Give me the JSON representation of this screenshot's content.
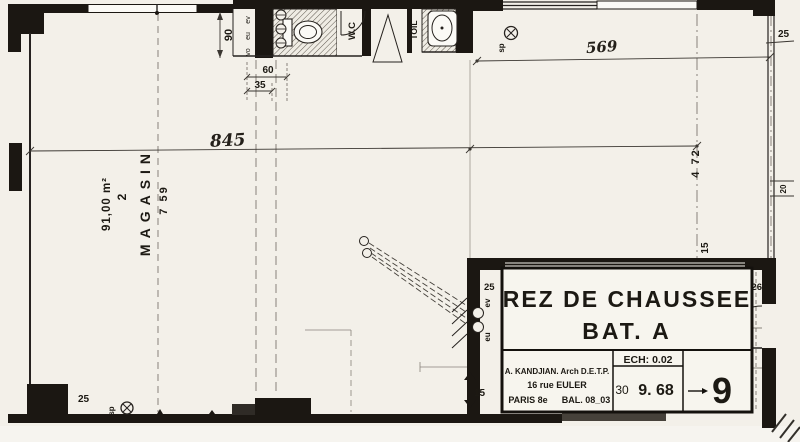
{
  "plan": {
    "rooms": {
      "magasin": {
        "label": "MAGASIN",
        "number": "2",
        "area": "91,00 m²"
      },
      "wc_label": "W.C",
      "toil_label": "TOIL"
    },
    "dimensions": {
      "width_845": "845",
      "width_569": "569",
      "height_759": "7 59",
      "height_472": "4 72",
      "wc_90": "90",
      "wc_60": "60",
      "wc_35": "35",
      "wall_25_top_right": "25",
      "wall_25_bottom_left": "25",
      "wall_25_office": "25",
      "wall_26": "26",
      "wall_15_office": "15",
      "wall_15_right": "15",
      "wall_20": "20"
    },
    "annotations": {
      "sp_top": "sp",
      "sp_bottom": "sp",
      "ev": "ev",
      "eu": "eu",
      "stack_1": "ev",
      "stack_2": "eu",
      "stack_3": "vo"
    }
  },
  "title_block": {
    "title_line1": "REZ DE CHAUSSEE",
    "title_line2": "BAT. A",
    "architect_name": "A. KANDJIAN. Arch D.E.T.P.",
    "architect_address": "16 rue EULER",
    "architect_city": "PARIS 8e",
    "architect_phone": "BAL. 08_03",
    "scale": "ECH: 0.02",
    "date_day": "30",
    "date": "9. 68",
    "sheet_number": "9"
  }
}
